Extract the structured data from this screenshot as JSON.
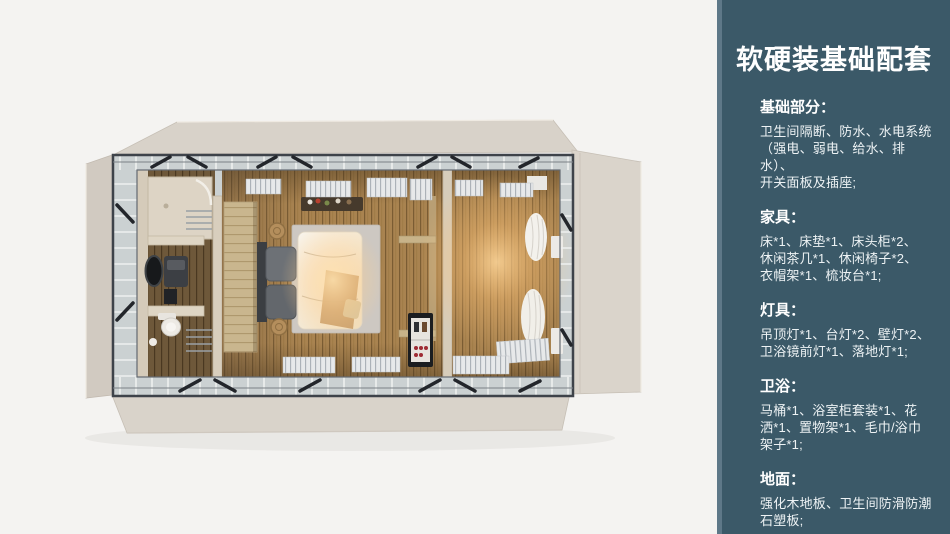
{
  "colors": {
    "page_bg": "#f4f3f1",
    "sidebar_bg": "#3b5968",
    "sidebar_strip": "#5e7888",
    "sidebar_text": "#ffffff"
  },
  "sidebar": {
    "title": "软硬装基础配套",
    "sections": [
      {
        "heading": "基础部分：",
        "body": "卫生间隔断、防水、水电系统\n（强电、弱电、给水、排水）、\n开关面板及插座;"
      },
      {
        "heading": "家具：",
        "body": "床*1、床垫*1、床头柜*2、\n休闲茶几*1、休闲椅子*2、\n衣帽架*1、梳妆台*1;"
      },
      {
        "heading": "灯具：",
        "body": "吊顶灯*1、台灯*2、壁灯*2、\n卫浴镜前灯*1、落地灯*1;"
      },
      {
        "heading": "卫浴：",
        "body": "马桶*1、浴室柜套装*1、花\n洒*1、置物架*1、毛巾/浴巾\n架子*1;"
      },
      {
        "heading": "地面：",
        "body": "强化木地板、卫生间防滑防潮\n石塑板;"
      }
    ]
  }
}
